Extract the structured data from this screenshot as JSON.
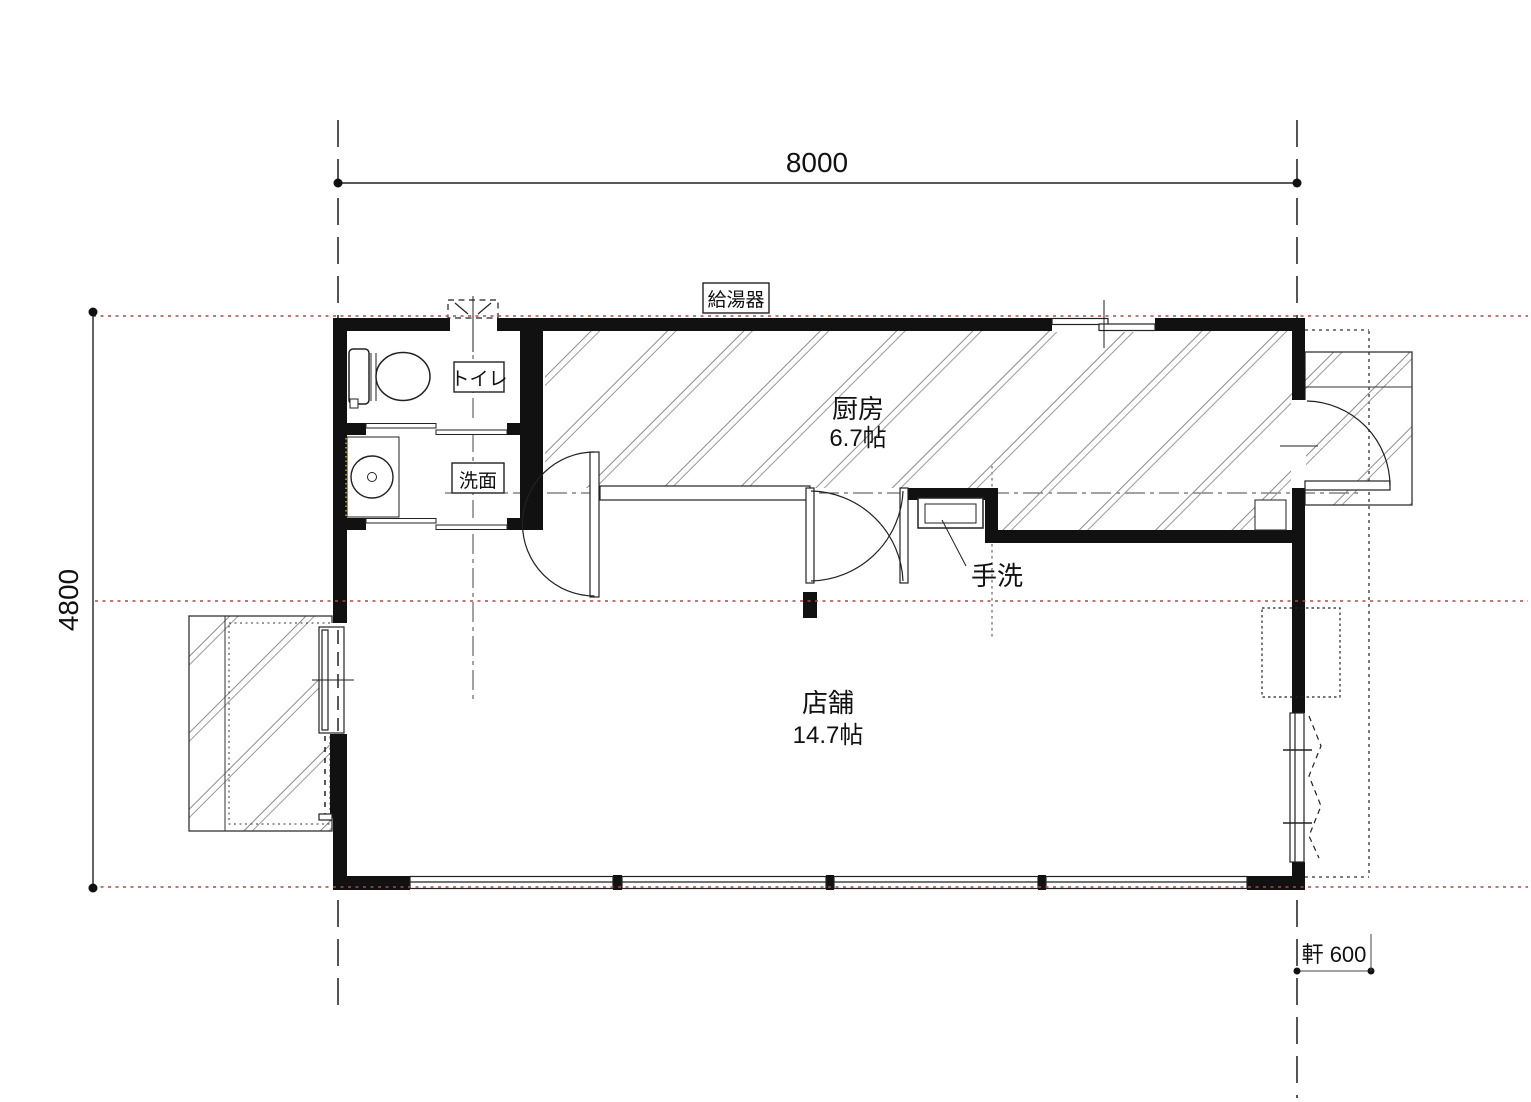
{
  "dimensions": {
    "width": "8000",
    "height": "4800",
    "eave": "軒 600"
  },
  "rooms": {
    "kitchen": {
      "name": "厨房",
      "area": "6.7帖"
    },
    "shop": {
      "name": "店舗",
      "area": "14.7帖"
    },
    "toilet": {
      "name": "トイレ"
    },
    "washroom": {
      "name": "洗面"
    },
    "handwash": {
      "name": "手洗"
    }
  },
  "equipment": {
    "water_heater": "給湯器"
  },
  "colors": {
    "wall": "#111111",
    "guide": "#b04848",
    "hatch": "#8a8a8a",
    "line": "#222222"
  }
}
